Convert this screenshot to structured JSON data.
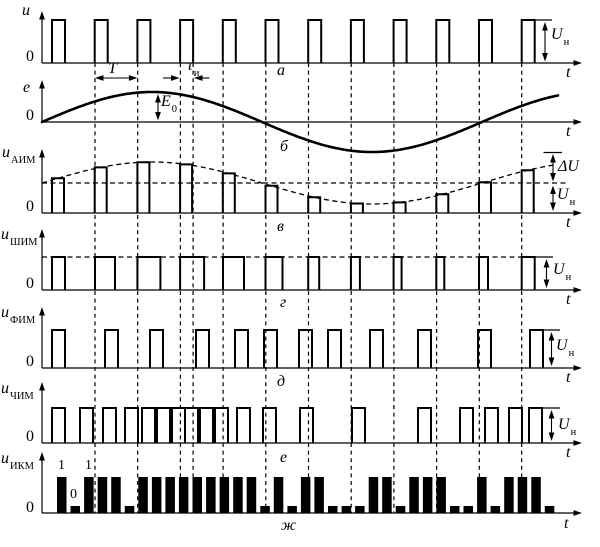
{
  "labels": {
    "row_a": {
      "axis": "u",
      "origin": "0",
      "t": "t",
      "period": "T",
      "tau": "τ",
      "tau_sub": "и",
      "un": "U",
      "un_sub": "н",
      "panel": "а"
    },
    "row_b": {
      "axis": "e",
      "origin": "0",
      "t": "t",
      "e0": "E",
      "e0_sub": "0",
      "panel": "б"
    },
    "row_c": {
      "axis": "u",
      "axis_sub": "АИМ",
      "origin": "0",
      "t": "t",
      "du": "ΔU",
      "un": "U",
      "un_sub": "н",
      "panel": "в"
    },
    "row_d": {
      "axis": "u",
      "axis_sub": "ШИМ",
      "origin": "0",
      "t": "t",
      "un": "U",
      "un_sub": "н",
      "panel": "г"
    },
    "row_e": {
      "axis": "u",
      "axis_sub": "ФИМ",
      "origin": "0",
      "t": "t",
      "un": "U",
      "un_sub": "н",
      "panel": "д"
    },
    "row_f": {
      "axis": "u",
      "axis_sub": "ЧИМ",
      "origin": "0",
      "t": "t",
      "un": "U",
      "un_sub": "н",
      "panel": "е"
    },
    "row_g": {
      "axis": "u",
      "axis_sub": "ИКМ",
      "origin": "0",
      "t": "t",
      "bits": [
        "1",
        "0",
        "1"
      ],
      "panel": "ж"
    }
  },
  "figure": {
    "width": 600,
    "height": 547,
    "colors": {
      "ink": "#000000",
      "background": "#ffffff"
    },
    "axis": {
      "x0": 42,
      "x_end": 577,
      "arrow_tip": 582
    },
    "grid_y": {
      "top": 63,
      "bottom": 513
    },
    "gridlines_x": [
      95,
      137.7,
      180.4,
      193.1,
      223.1,
      265.8,
      308.5,
      351.2,
      393.9,
      436.6,
      479.3,
      521.7
    ],
    "rows": [
      {
        "panel": "а",
        "type": "pulses",
        "axis_y": 63,
        "v_top": 11,
        "pulse_top": 20,
        "pulse_w": 13,
        "pulse_x": [
          52,
          94.7,
          137.4,
          180.1,
          222.8,
          265.5,
          308.2,
          350.9,
          393.6,
          436.3,
          479,
          521.7
        ],
        "ann": [
          [
            "harrow",
            95,
            137.4,
            78
          ],
          [
            "arrow1",
            163,
            78,
            179.5,
            78
          ],
          [
            "arrow1",
            209.5,
            78,
            194,
            78
          ],
          [
            "tick",
            534.7,
            20,
            552,
            20
          ],
          [
            "varrow",
            545,
            22,
            61.5
          ]
        ]
      },
      {
        "panel": "б",
        "type": "sine",
        "axis_y": 122,
        "v_top": 80,
        "amp": 30,
        "period": 440,
        "x1": 42,
        "x2": 558,
        "ann": [
          [
            "varrow",
            158,
            94,
            120.5
          ]
        ]
      },
      {
        "panel": "в",
        "type": "pulses",
        "axis_y": 213,
        "v_top": 149,
        "pulse_w": 12,
        "pulse_x": [
          52,
          94.7,
          137.4,
          180.1,
          222.8,
          265.5,
          308.2,
          350.9,
          393.6,
          436.3,
          479,
          521.7
        ],
        "pulse_top": [
          178.2,
          167.4,
          162.2,
          164.4,
          173.4,
          185.8,
          197.3,
          203.5,
          202.4,
          194.3,
          182.2,
          170.3
        ],
        "mean_line": {
          "y": 183,
          "x1": 42,
          "x2": 568
        },
        "envelope": {
          "mean": 183,
          "amp": 21,
          "period": 440,
          "x1": 42,
          "x2": 557
        },
        "ann": [
          [
            "tick",
            543.5,
            152.5,
            562,
            152.5
          ],
          [
            "varrow",
            553,
            154,
            181.5
          ],
          [
            "varrow",
            553,
            185.5,
            211
          ]
        ]
      },
      {
        "panel": "г",
        "type": "pulses",
        "axis_y": 290,
        "v_top": 229,
        "pulse_top": 257,
        "pulse_w": [
          13,
          20,
          23,
          24,
          21,
          17,
          11,
          9,
          8,
          8,
          9,
          13
        ],
        "pulse_x": [
          52,
          95,
          137.4,
          180.1,
          223,
          265.5,
          308.2,
          350.9,
          393.6,
          436.3,
          479,
          521.7
        ],
        "top_dash": {
          "y": 257,
          "x1": 42,
          "x2": 521.7
        },
        "ann": [
          [
            "tick",
            534.7,
            257,
            553,
            257
          ],
          [
            "varrow",
            546.5,
            259,
            288
          ]
        ]
      },
      {
        "panel": "д",
        "type": "pulses",
        "axis_y": 368,
        "v_top": 307,
        "pulse_top": 330,
        "pulse_w": 13,
        "pulse_x": [
          52,
          105,
          150,
          196,
          235,
          264,
          299,
          328,
          370,
          418,
          478,
          530
        ],
        "ann": [
          [
            "tick",
            543,
            330,
            560,
            330
          ],
          [
            "varrow",
            551.5,
            332,
            366
          ]
        ]
      },
      {
        "panel": "е",
        "type": "pulses",
        "axis_y": 443,
        "v_top": 382,
        "pulse_top": 408,
        "pulse_w": 13,
        "pulse_x": [
          52,
          80,
          103,
          125,
          142,
          157,
          172,
          185,
          200,
          215,
          237,
          263,
          300,
          352,
          418,
          460,
          485,
          509,
          529
        ],
        "ann": [
          [
            "tick",
            542,
            408,
            560,
            408
          ],
          [
            "varrow",
            551.5,
            410,
            441
          ]
        ]
      },
      {
        "panel": "ж",
        "type": "pcm",
        "axis_y": 513,
        "v_top": 452,
        "tall_top": 477,
        "short_top": 506,
        "x0": 57,
        "pitch": 13.55,
        "bar_w": 9.5,
        "bits": "1011101111111110101100011011100101110",
        "ann": []
      }
    ]
  }
}
